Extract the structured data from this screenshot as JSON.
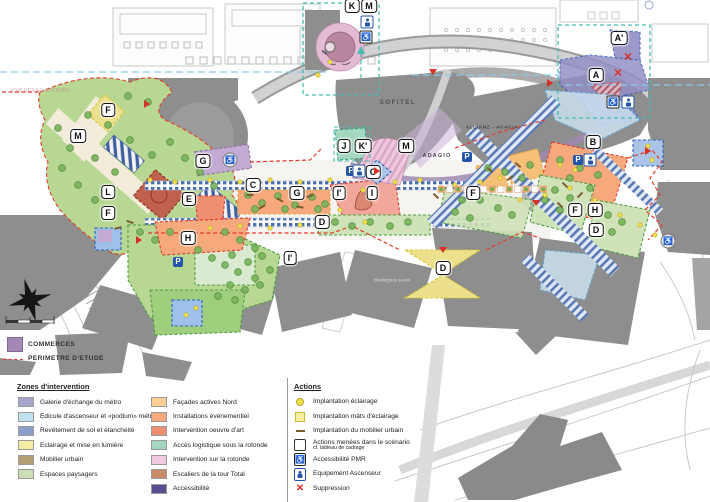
{
  "map": {
    "region_labels": [
      {
        "t": "K",
        "x": 352,
        "y": 6
      },
      {
        "t": "M",
        "x": 369,
        "y": 6
      },
      {
        "t": "A'",
        "x": 619,
        "y": 38
      },
      {
        "t": "A",
        "x": 596,
        "y": 75
      },
      {
        "t": "B",
        "x": 593,
        "y": 142
      },
      {
        "t": "F",
        "x": 108,
        "y": 110
      },
      {
        "t": "M",
        "x": 78,
        "y": 136
      },
      {
        "t": "G",
        "x": 203,
        "y": 161
      },
      {
        "t": "L",
        "x": 108,
        "y": 192
      },
      {
        "t": "E",
        "x": 189,
        "y": 199
      },
      {
        "t": "F",
        "x": 108,
        "y": 213
      },
      {
        "t": "H",
        "x": 188,
        "y": 238
      },
      {
        "t": "C",
        "x": 253,
        "y": 185
      },
      {
        "t": "C",
        "x": 373,
        "y": 172
      },
      {
        "t": "G",
        "x": 297,
        "y": 193
      },
      {
        "t": "I'",
        "x": 339,
        "y": 193
      },
      {
        "t": "I",
        "x": 372,
        "y": 193
      },
      {
        "t": "D",
        "x": 322,
        "y": 222
      },
      {
        "t": "I'",
        "x": 290,
        "y": 258
      },
      {
        "t": "J",
        "x": 344,
        "y": 146
      },
      {
        "t": "K'",
        "x": 363,
        "y": 146
      },
      {
        "t": "M",
        "x": 406,
        "y": 146
      },
      {
        "t": "F",
        "x": 473,
        "y": 193
      },
      {
        "t": "F",
        "x": 575,
        "y": 210
      },
      {
        "t": "H",
        "x": 595,
        "y": 210
      },
      {
        "t": "D",
        "x": 596,
        "y": 230
      },
      {
        "t": "D",
        "x": 443,
        "y": 268
      }
    ],
    "building_names": [
      {
        "id": "sofitel",
        "t": "SOFITEL",
        "x": 398,
        "y": 103
      },
      {
        "id": "allianz",
        "t": "ALLIANZ - ACACIA",
        "x": 492,
        "y": 127
      },
      {
        "id": "adagio",
        "t": "ADAGIO",
        "x": 437,
        "y": 156
      },
      {
        "id": "boulangerie",
        "t": "Boulangerie à vent",
        "x": 392,
        "y": 280
      },
      {
        "id": "voie",
        "t": "VOIE DES SCULPTEURS",
        "x": 40,
        "y": 90
      }
    ],
    "icons": {
      "parking_letter": "P",
      "pmr_glyph": "♿",
      "suppression_glyph": "✕",
      "parking": [
        [
          178,
          262
        ],
        [
          351,
          171
        ],
        [
          467,
          157
        ],
        [
          578,
          160
        ]
      ],
      "elevator": [
        [
          367,
          22
        ],
        [
          359,
          171
        ],
        [
          628,
          102
        ],
        [
          590,
          160
        ]
      ],
      "pmr_square": [
        [
          366,
          37
        ],
        [
          613,
          102
        ]
      ],
      "pmr_round": [
        [
          230,
          160
        ],
        [
          668,
          241
        ]
      ],
      "suppression": [
        [
          628,
          58
        ],
        [
          618,
          74
        ]
      ],
      "triangles": [
        {
          "x": 147,
          "y": 104,
          "dir": "right"
        },
        {
          "x": 377,
          "y": 171,
          "dir": "right"
        },
        {
          "x": 648,
          "y": 151,
          "dir": "right"
        },
        {
          "x": 536,
          "y": 203,
          "dir": "down"
        },
        {
          "x": 443,
          "y": 250,
          "dir": "down"
        },
        {
          "x": 139,
          "y": 240,
          "dir": "right"
        },
        {
          "x": 433,
          "y": 72,
          "dir": "down"
        },
        {
          "x": 550,
          "y": 83,
          "dir": "right"
        }
      ],
      "magnifier": [
        [
          330,
          47
        ]
      ]
    },
    "decorations": {
      "trees": [
        [
          58,
          128
        ],
        [
          70,
          148
        ],
        [
          62,
          168
        ],
        [
          78,
          185
        ],
        [
          95,
          200
        ],
        [
          112,
          210
        ],
        [
          88,
          115
        ],
        [
          108,
          125
        ],
        [
          130,
          140
        ],
        [
          152,
          155
        ],
        [
          170,
          142
        ],
        [
          185,
          158
        ],
        [
          148,
          102
        ],
        [
          128,
          96
        ],
        [
          200,
          172
        ],
        [
          214,
          186
        ],
        [
          95,
          158
        ],
        [
          115,
          172
        ],
        [
          248,
          195
        ],
        [
          262,
          203
        ],
        [
          278,
          196
        ],
        [
          295,
          205
        ],
        [
          312,
          197
        ],
        [
          325,
          204
        ],
        [
          255,
          209
        ],
        [
          285,
          209
        ],
        [
          318,
          209
        ],
        [
          335,
          222
        ],
        [
          352,
          226
        ],
        [
          370,
          222
        ],
        [
          390,
          226
        ],
        [
          408,
          222
        ],
        [
          140,
          232
        ],
        [
          155,
          240
        ],
        [
          170,
          232
        ],
        [
          225,
          232
        ],
        [
          240,
          240
        ],
        [
          255,
          248
        ],
        [
          232,
          255
        ],
        [
          248,
          262
        ],
        [
          262,
          256
        ],
        [
          270,
          270
        ],
        [
          255,
          278
        ],
        [
          238,
          272
        ],
        [
          225,
          265
        ],
        [
          212,
          258
        ],
        [
          198,
          250
        ],
        [
          230,
          285
        ],
        [
          245,
          290
        ],
        [
          260,
          285
        ],
        [
          218,
          296
        ],
        [
          235,
          300
        ],
        [
          555,
          190
        ],
        [
          570,
          198
        ],
        [
          560,
          210
        ],
        [
          545,
          200
        ],
        [
          608,
          215
        ],
        [
          622,
          222
        ],
        [
          612,
          232
        ],
        [
          598,
          225
        ],
        [
          480,
          200
        ],
        [
          498,
          208
        ],
        [
          512,
          215
        ],
        [
          462,
          200
        ],
        [
          455,
          212
        ],
        [
          470,
          218
        ],
        [
          560,
          160
        ],
        [
          580,
          168
        ],
        [
          598,
          175
        ],
        [
          570,
          178
        ],
        [
          590,
          188
        ],
        [
          488,
          168
        ],
        [
          505,
          172
        ],
        [
          522,
          178
        ],
        [
          530,
          165
        ]
      ],
      "lights": [
        [
          150,
          180
        ],
        [
          175,
          182
        ],
        [
          210,
          180
        ],
        [
          240,
          182
        ],
        [
          270,
          180
        ],
        [
          300,
          182
        ],
        [
          330,
          180
        ],
        [
          395,
          182
        ],
        [
          420,
          180
        ],
        [
          455,
          185
        ],
        [
          480,
          182
        ],
        [
          500,
          178
        ],
        [
          520,
          200
        ],
        [
          545,
          195
        ],
        [
          570,
          188
        ],
        [
          595,
          200
        ],
        [
          620,
          215
        ],
        [
          640,
          225
        ],
        [
          655,
          235
        ],
        [
          363,
          190
        ],
        [
          340,
          210
        ],
        [
          365,
          222
        ],
        [
          300,
          225
        ],
        [
          270,
          228
        ],
        [
          240,
          226
        ],
        [
          210,
          228
        ],
        [
          180,
          262
        ],
        [
          196,
          308
        ],
        [
          186,
          315
        ],
        [
          648,
          146
        ],
        [
          652,
          160
        ],
        [
          560,
          165
        ],
        [
          575,
          170
        ],
        [
          330,
          62
        ],
        [
          318,
          75
        ]
      ],
      "furniture": [
        [
          250,
          195,
          0
        ],
        [
          280,
          200,
          30
        ],
        [
          310,
          196,
          -20
        ],
        [
          300,
          207,
          10
        ],
        [
          262,
          207,
          -30
        ],
        [
          490,
          170,
          40
        ],
        [
          510,
          178,
          -40
        ],
        [
          565,
          185,
          45
        ],
        [
          580,
          195,
          -45
        ],
        [
          560,
          205,
          45
        ],
        [
          518,
          165,
          40
        ],
        [
          130,
          222,
          20
        ],
        [
          118,
          228,
          -15
        ],
        [
          436,
          196,
          45
        ]
      ],
      "checker_row": {
        "x0": 438,
        "y": 186,
        "n": 13,
        "step": 8.5
      }
    }
  },
  "upper_legend": {
    "commerces_label": "COMMERCES",
    "commerces_color": "#a289b5",
    "perimeter_label": "PERIMETRE D'ETUDE",
    "perimeter_color": "#e23b2e"
  },
  "zones_legend": {
    "title": "Zones d'intervention",
    "col1": [
      {
        "label": "Galerie d'échange du métro",
        "color": "#a6a5cc"
      },
      {
        "label": "Edicule d'ascenseur et «podium» métro",
        "color": "#bfe1f0"
      },
      {
        "label": "Revêtement de sol et étanchéité",
        "color": "#8aa0c8"
      },
      {
        "label": "Eclairage et mise en lumière",
        "color": "#f3eea1"
      },
      {
        "label": "Mobilier urbain",
        "color": "#b29e74"
      },
      {
        "label": "Espaces paysagers",
        "color": "#ccdfb4"
      }
    ],
    "col2": [
      {
        "label": "Façades actives Nord",
        "color": "#f9cf97"
      },
      {
        "label": "Installations événementiel",
        "color": "#f5a97d"
      },
      {
        "label": "Intervention oeuvre d'art",
        "color": "#ef8f72"
      },
      {
        "label": "Accès logistique sous la rotonde",
        "color": "#a3d6bf"
      },
      {
        "label": "Intervention sur la rotonde",
        "color": "#f0cadf"
      },
      {
        "label": "Escaliers de la tour Total",
        "color": "#c98a6b"
      },
      {
        "label": "Accessibilité",
        "color": "#574f90"
      }
    ]
  },
  "actions_legend": {
    "title": "Actions",
    "items": [
      {
        "icon": "dot",
        "label": "Implantation éclairage"
      },
      {
        "icon": "square",
        "label": "Implantation mâts d'éclairage"
      },
      {
        "icon": "dash",
        "label": "Implantation du mobilier urbain"
      },
      {
        "icon": "scenario",
        "label": "Actions menées dans le scénario",
        "sub": "cf. tableau de cadrage"
      },
      {
        "icon": "pmr",
        "label": "Accessibilité PMR"
      },
      {
        "icon": "elevator",
        "label": "Equipement Ascenseur"
      },
      {
        "icon": "x",
        "label": "Suppression"
      }
    ]
  }
}
